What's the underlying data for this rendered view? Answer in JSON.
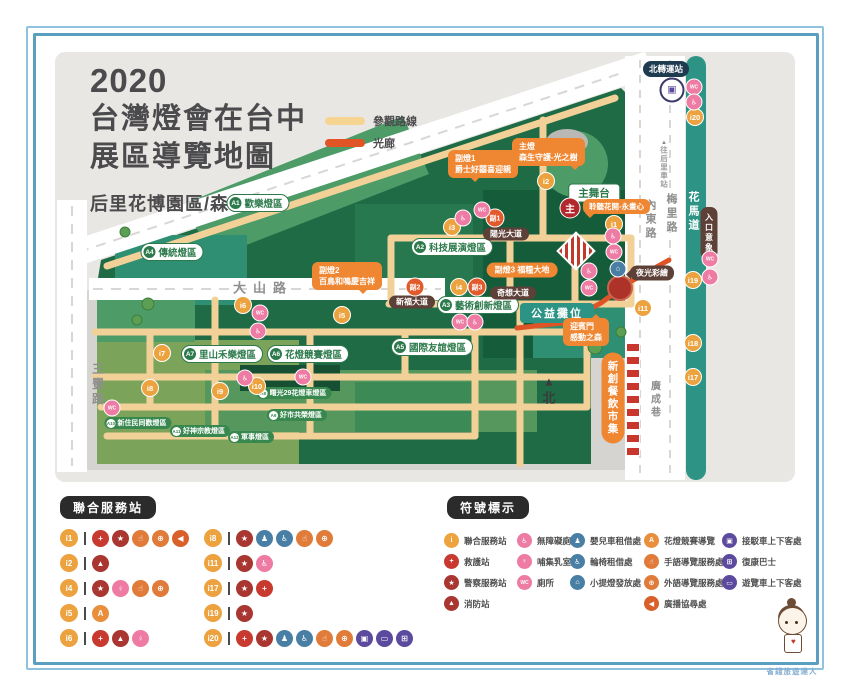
{
  "title": {
    "line1": "2020",
    "line2": "台灣燈會在台中",
    "line3": "展區導覽地圖",
    "subtitle": "后里花博園區/森林園區"
  },
  "route_legend": [
    {
      "label": "參觀路線",
      "color": "#f6d492"
    },
    {
      "label": "光廊",
      "color": "#e05426"
    }
  ],
  "map": {
    "roads": {
      "dashan": "大山路",
      "sanfeng": "三豐路",
      "neidong": "內東路",
      "meili": "梅里路",
      "huamadao": "花馬道",
      "guangcheng": "廣成巷",
      "to_houli": "往后里車站",
      "to_houli_arrow": "▲"
    },
    "stations": {
      "north_terminal": "北轉運站",
      "entrance": "入口意象",
      "night_paint": "夜光彩繪"
    },
    "stage": "主舞台",
    "charity": "公益攤位",
    "market": "新創餐飲市集",
    "compass": "北",
    "compass_arrow": "▲",
    "main_badge": {
      "label": "主",
      "x": 570,
      "y": 208
    },
    "callouts": {
      "main": {
        "title": "主燈",
        "text": "森生守護-光之樹"
      },
      "sub1": {
        "title": "副燈1",
        "text": "爵士好囍喜迎親"
      },
      "sub2": {
        "title": "副燈2",
        "text": "百鳥和鳴慶吉祥"
      },
      "sub3": {
        "text": "副燈3 福糧大地"
      },
      "listen": {
        "text": "聆聽花開-永晝心"
      },
      "gate": {
        "title": "迎賓門",
        "text": "感動之森"
      }
    },
    "avenues": [
      {
        "label": "陽光大道",
        "x": 506,
        "y": 234
      },
      {
        "label": "新福大道",
        "x": 412,
        "y": 302
      },
      {
        "label": "奇想大道",
        "x": 513,
        "y": 293
      }
    ],
    "zones": [
      {
        "id": "A1",
        "label": "歡樂燈區",
        "x": 258,
        "y": 203
      },
      {
        "id": "A2",
        "label": "科技展演燈區",
        "x": 452,
        "y": 247
      },
      {
        "id": "A3",
        "label": "藝術創新燈區",
        "x": 478,
        "y": 305
      },
      {
        "id": "A4",
        "label": "傳統燈區",
        "x": 172,
        "y": 252
      },
      {
        "id": "A5",
        "label": "國際友誼燈區",
        "x": 432,
        "y": 347
      },
      {
        "id": "A6",
        "label": "花燈競賽燈區",
        "x": 308,
        "y": 354
      },
      {
        "id": "A7",
        "label": "里山禾樂燈區",
        "x": 222,
        "y": 354
      }
    ],
    "small_zones": [
      {
        "id": "A8",
        "label": "曙光29花燈車燈區",
        "x": 294,
        "y": 393
      },
      {
        "id": "A9",
        "label": "好市共榮燈區",
        "x": 297,
        "y": 415
      },
      {
        "id": "A10",
        "label": "新住民同歡燈區",
        "x": 138,
        "y": 423
      },
      {
        "id": "A11",
        "label": "好神宗教燈區",
        "x": 200,
        "y": 431
      },
      {
        "id": "A12",
        "label": "軍事燈區",
        "x": 251,
        "y": 437
      }
    ],
    "ibadges": [
      {
        "id": "i1",
        "x": 614,
        "y": 224
      },
      {
        "id": "i2",
        "x": 546,
        "y": 181
      },
      {
        "id": "i3",
        "x": 452,
        "y": 227
      },
      {
        "id": "i4",
        "x": 459,
        "y": 287
      },
      {
        "id": "i5",
        "x": 342,
        "y": 315
      },
      {
        "id": "i6",
        "x": 243,
        "y": 305
      },
      {
        "id": "i7",
        "x": 162,
        "y": 353
      },
      {
        "id": "i8",
        "x": 150,
        "y": 388
      },
      {
        "id": "i9",
        "x": 220,
        "y": 391
      },
      {
        "id": "i10",
        "x": 257,
        "y": 386
      },
      {
        "id": "i11",
        "x": 643,
        "y": 308
      },
      {
        "id": "i17",
        "x": 693,
        "y": 377
      },
      {
        "id": "i18",
        "x": 693,
        "y": 343
      },
      {
        "id": "i19",
        "x": 693,
        "y": 280
      },
      {
        "id": "i20",
        "x": 695,
        "y": 117
      }
    ],
    "sub_badges": [
      {
        "id": "副1",
        "x": 495,
        "y": 218
      },
      {
        "id": "副2",
        "x": 415,
        "y": 287
      },
      {
        "id": "副3",
        "x": 477,
        "y": 287
      }
    ],
    "map_icons": [
      {
        "t": "toilet",
        "x": 694,
        "y": 87
      },
      {
        "t": "accessible_toilet",
        "x": 694,
        "y": 102
      },
      {
        "t": "toilet",
        "x": 710,
        "y": 259
      },
      {
        "t": "accessible_toilet",
        "x": 710,
        "y": 277
      },
      {
        "t": "toilet",
        "x": 482,
        "y": 210
      },
      {
        "t": "accessible_toilet",
        "x": 463,
        "y": 218
      },
      {
        "t": "accessible_toilet",
        "x": 613,
        "y": 236
      },
      {
        "t": "toilet",
        "x": 614,
        "y": 252
      },
      {
        "t": "lantern",
        "x": 618,
        "y": 269
      },
      {
        "t": "accessible_toilet",
        "x": 589,
        "y": 271
      },
      {
        "t": "toilet",
        "x": 589,
        "y": 288
      },
      {
        "t": "toilet",
        "x": 260,
        "y": 313
      },
      {
        "t": "accessible_toilet",
        "x": 258,
        "y": 331
      },
      {
        "t": "accessible_toilet",
        "x": 245,
        "y": 378
      },
      {
        "t": "toilet",
        "x": 303,
        "y": 377
      },
      {
        "t": "toilet",
        "x": 112,
        "y": 408
      },
      {
        "t": "toilet",
        "x": 460,
        "y": 322
      },
      {
        "t": "accessible_toilet",
        "x": 475,
        "y": 322
      }
    ]
  },
  "services": {
    "header": "聯合服務站",
    "rows": [
      {
        "id": "i1",
        "icons": [
          "first_aid",
          "police",
          "sign_language",
          "foreign_language",
          "broadcast"
        ]
      },
      {
        "id": "i2",
        "icons": [
          "fire"
        ]
      },
      {
        "id": "i4",
        "icons": [
          "police",
          "nursing_room",
          "sign_language",
          "foreign_language"
        ]
      },
      {
        "id": "i5",
        "icons": [
          "competition_guide"
        ]
      },
      {
        "id": "i6",
        "icons": [
          "first_aid",
          "fire",
          "nursing_room"
        ]
      },
      {
        "id": "i8",
        "icons": [
          "police",
          "stroller_rental",
          "wheelchair_rental",
          "sign_language",
          "foreign_language"
        ]
      },
      {
        "id": "i11",
        "icons": [
          "police",
          "accessible_toilet"
        ]
      },
      {
        "id": "i17",
        "icons": [
          "police",
          "first_aid"
        ]
      },
      {
        "id": "i19",
        "icons": [
          "police"
        ]
      },
      {
        "id": "i20",
        "icons": [
          "first_aid",
          "police",
          "stroller_rental",
          "wheelchair_rental",
          "sign_language",
          "foreign_language",
          "shuttle_stop",
          "tour_bus_stop",
          "rehab_bus"
        ]
      }
    ]
  },
  "symbols": {
    "header": "符號標示",
    "columns": [
      [
        {
          "icon": "union_service",
          "label": "聯合服務站"
        },
        {
          "icon": "first_aid",
          "label": "救護站"
        },
        {
          "icon": "police",
          "label": "警察服務站"
        },
        {
          "icon": "fire",
          "label": "消防站"
        }
      ],
      [
        {
          "icon": "accessible_toilet",
          "label": "無障礙廁所"
        },
        {
          "icon": "nursing_room",
          "label": "哺集乳室"
        },
        {
          "icon": "toilet",
          "label": "廁所"
        }
      ],
      [
        {
          "icon": "stroller_rental",
          "label": "嬰兒車租借處"
        },
        {
          "icon": "wheelchair_rental",
          "label": "輪椅租借處"
        },
        {
          "icon": "lantern",
          "label": "小提燈發放處"
        }
      ],
      [
        {
          "icon": "competition_guide",
          "label": "花燈競賽導覽"
        },
        {
          "icon": "sign_language",
          "label": "手語導覽服務處"
        },
        {
          "icon": "foreign_language",
          "label": "外語導覽服務處"
        },
        {
          "icon": "broadcast",
          "label": "廣播協尋處"
        }
      ],
      [
        {
          "icon": "shuttle_stop",
          "label": "接駁車上下客處"
        },
        {
          "icon": "rehab_bus",
          "label": "復康巴士"
        },
        {
          "icon": "tour_bus_stop",
          "label": "遊覽車上下客處"
        }
      ]
    ]
  },
  "icon_defs": {
    "union_service": {
      "glyph": "i",
      "color": "#eea43e"
    },
    "first_aid": {
      "glyph": "+",
      "color": "#c8392f"
    },
    "police": {
      "glyph": "★",
      "color": "#a93630"
    },
    "fire": {
      "glyph": "▲",
      "color": "#a93630"
    },
    "accessible_toilet": {
      "glyph": "♿",
      "color": "#ee7ba3"
    },
    "nursing_room": {
      "glyph": "♀",
      "color": "#ee7ba3"
    },
    "toilet": {
      "glyph": "WC",
      "color": "#ee7ba3"
    },
    "stroller_rental": {
      "glyph": "♟",
      "color": "#4a7fa5"
    },
    "wheelchair_rental": {
      "glyph": "♿",
      "color": "#4a7fa5"
    },
    "lantern": {
      "glyph": "⌂",
      "color": "#4a7fa5"
    },
    "competition_guide": {
      "glyph": "A",
      "color": "#e98f3c"
    },
    "sign_language": {
      "glyph": "☝",
      "color": "#e07b39"
    },
    "foreign_language": {
      "glyph": "⊕",
      "color": "#e07b39"
    },
    "broadcast": {
      "glyph": "◀",
      "color": "#d95f2b"
    },
    "shuttle_stop": {
      "glyph": "▣",
      "color": "#5b4a9e"
    },
    "rehab_bus": {
      "glyph": "⊞",
      "color": "#5b4a9e"
    },
    "tour_bus_stop": {
      "glyph": "▭",
      "color": "#5b4a9e"
    }
  },
  "mascot": {
    "caption": "省錢旅遊達人",
    "heart": "♥"
  }
}
